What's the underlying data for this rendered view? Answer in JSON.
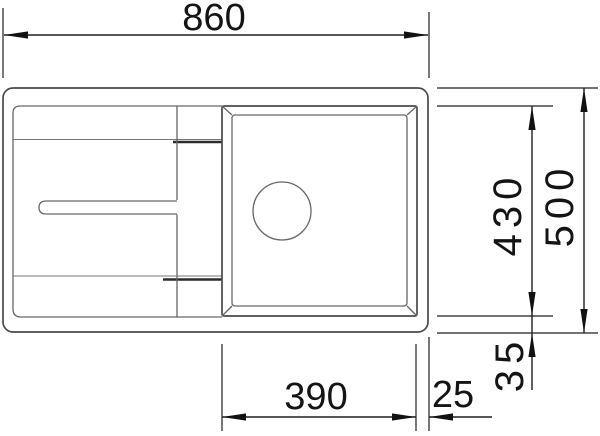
{
  "drawing": {
    "type": "technical-dimension-drawing",
    "subject": "kitchen sink with drainboard and single bowl, top view",
    "colors": {
      "background": "#ffffff",
      "sink_outline": "#4a4a4a",
      "inner_detail": "#676767",
      "dimension_lines": "#1f1f1f",
      "dimension_text": "#141414"
    },
    "dimensions": {
      "overall_width": {
        "label": "860",
        "position": "top"
      },
      "overall_depth": {
        "label": "500",
        "position": "right-outer",
        "orientation": "vertical"
      },
      "bowl_depth": {
        "label": "430",
        "position": "right-inner",
        "orientation": "vertical"
      },
      "bowl_bottom_offset": {
        "label": "35",
        "position": "bottom-right",
        "orientation": "vertical"
      },
      "bowl_width": {
        "label": "390",
        "position": "bottom"
      },
      "right_edge_gap": {
        "label": "25",
        "position": "bottom-right"
      }
    }
  }
}
